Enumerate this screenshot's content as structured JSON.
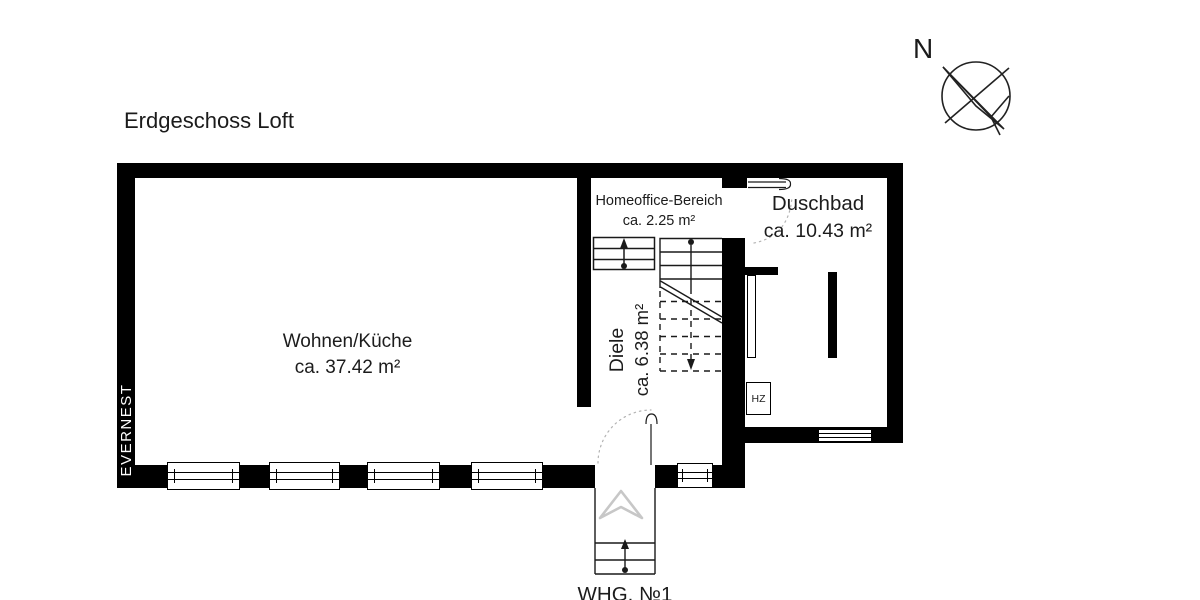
{
  "title": "Erdgeschoss Loft",
  "compass": {
    "label": "N"
  },
  "watermark": {
    "label": "EVERNEST"
  },
  "rooms": {
    "wohnen_kueche": {
      "name": "Wohnen/Küche",
      "area": "ca. 37.42 m²"
    },
    "homeoffice": {
      "name": "Homeoffice-Bereich",
      "area": "ca. 2.25 m²"
    },
    "duschbad": {
      "name": "Duschbad",
      "area": "ca. 10.43 m²"
    },
    "diele": {
      "name": "Diele",
      "area": "ca. 6.38 m²"
    },
    "heizung": {
      "label": "HZ"
    }
  },
  "entrance": {
    "unit_label": "WHG. №1"
  },
  "colors": {
    "wall": "#000000",
    "line": "#1a1a1a",
    "text": "#1c1c1c",
    "swing_dotted": "#b3b3b3",
    "entrance_arrow": "#c7c7c7",
    "background": "#ffffff"
  }
}
